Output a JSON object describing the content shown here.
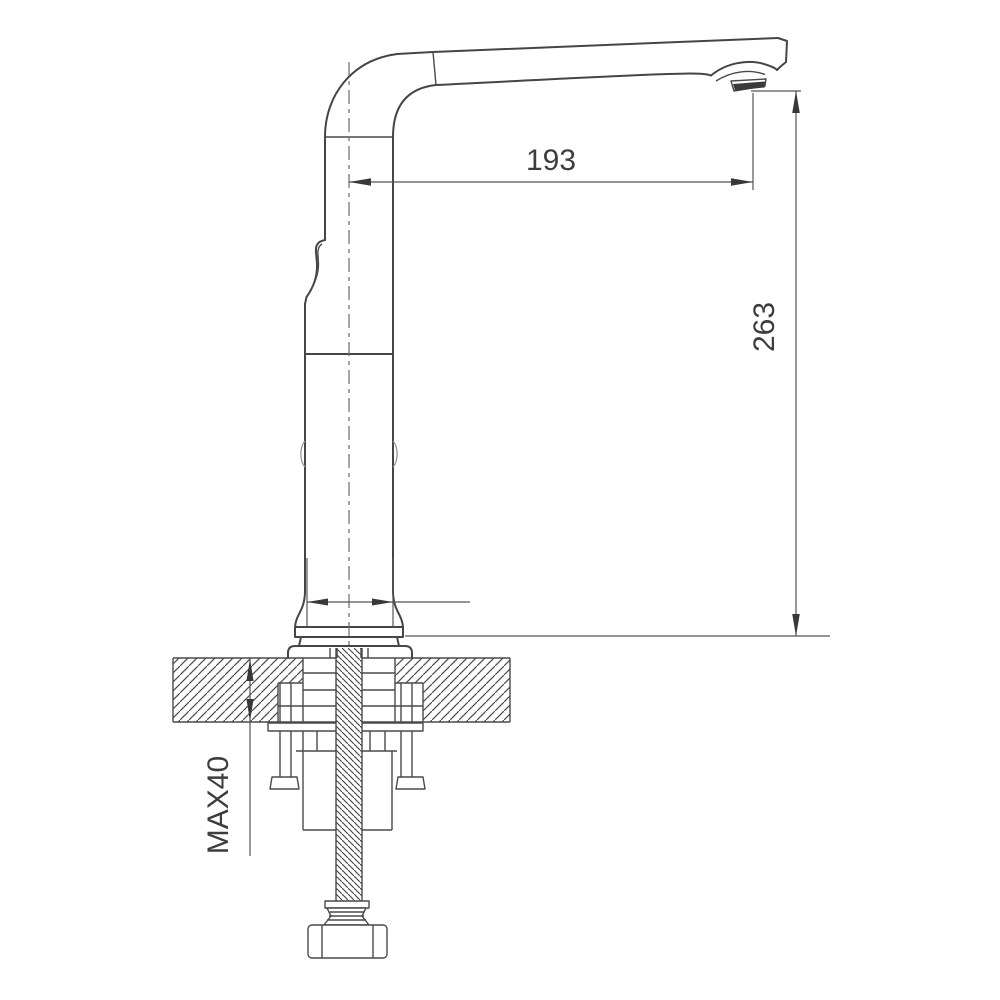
{
  "drawing": {
    "title": "faucet-installation-technical-drawing",
    "dimension_labels": {
      "spout_reach": "193",
      "overall_height": "263",
      "max_counter_thickness": "MAX40"
    },
    "colors": {
      "outline": "#454545",
      "dimension_line": "#555555",
      "text": "#3d3d3d",
      "background": "#ffffff"
    }
  }
}
